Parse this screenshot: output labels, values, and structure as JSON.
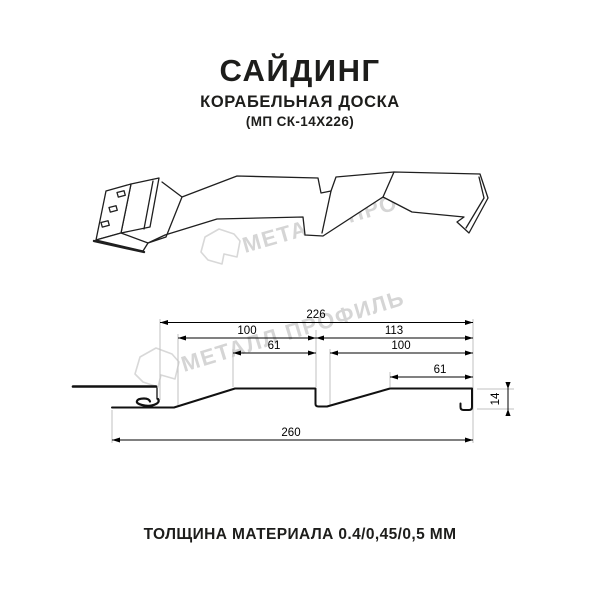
{
  "header": {
    "title": "САЙДИНГ",
    "subtitle": "КОРАБЕЛЬНАЯ ДОСКА",
    "model": "(МП СК-14Х226)"
  },
  "footer": {
    "thickness_note": "ТОЛЩИНА МАТЕРИАЛА 0.4/0,45/0,5 ММ"
  },
  "watermark": {
    "text": "МЕТАЛЛ ПРОФИЛЬ"
  },
  "dimensions": {
    "overall_top": "226",
    "left_panel": "100",
    "right_panel": "113",
    "left_flat": "61",
    "right_inner": "100",
    "right_flat": "61",
    "total_width": "260",
    "height": "14"
  },
  "colors": {
    "drawing_line": "#1a1a1a",
    "dimension_line": "#000000",
    "extension_line": "#c2c2c2",
    "watermark": "#d5d5d5",
    "text": "#1d1d1b"
  }
}
